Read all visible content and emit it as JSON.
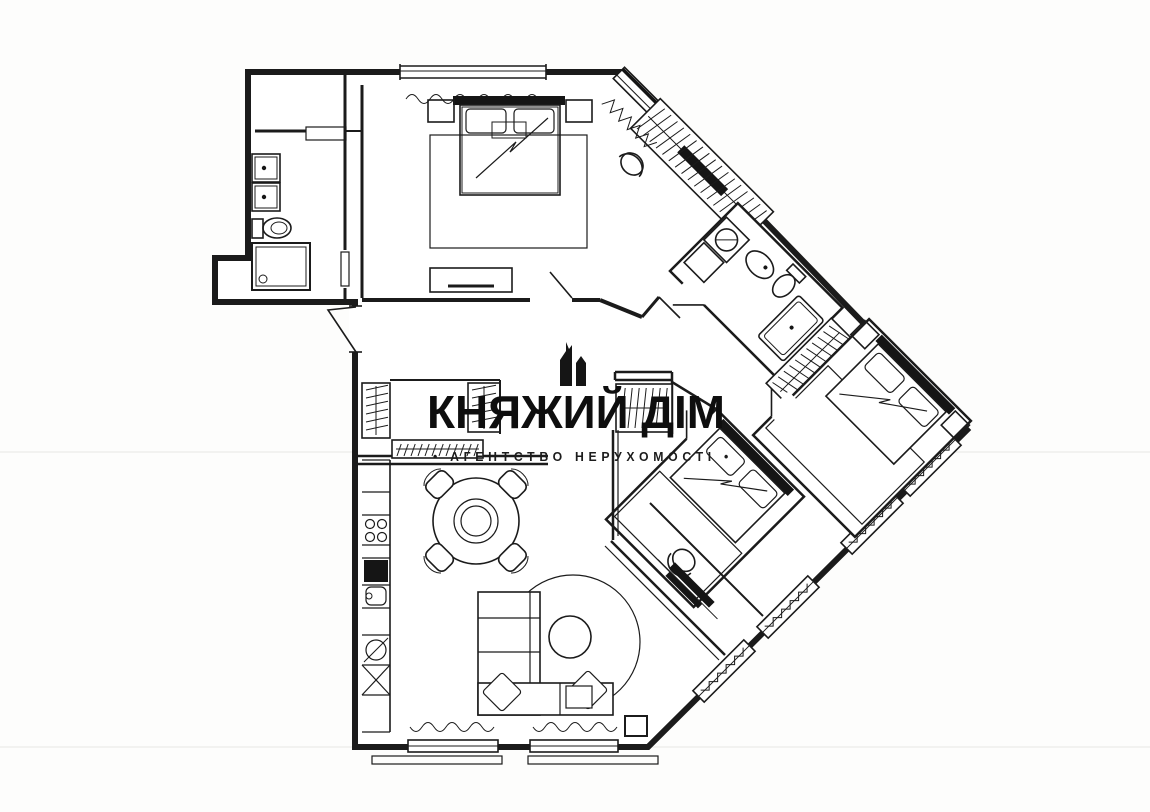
{
  "watermark": {
    "title": "КНЯЖИЙ ДІМ",
    "subtitle": "• АГЕНТСТВО  НЕРУХОМОСТІ •",
    "icon": "castle-towers-icon",
    "text_color": "#111111"
  },
  "plan": {
    "page_background": "#f4f4f2",
    "canvas_background": "#fdfdfc",
    "line_color": "#1b1b1b",
    "fixture_icons": [
      "double-sink-icon",
      "toilet-icon",
      "shower-icon",
      "wardrobe-hangers-icon",
      "double-bed-icon",
      "nightstand-icon",
      "rug-icon",
      "dresser-icon",
      "armchair-icon",
      "washing-machine-icon",
      "sink-icon",
      "shower-tray-icon",
      "dining-table-icon",
      "dining-chair-icon",
      "cooktop-icon",
      "kitchen-sink-icon",
      "dishwasher-icon",
      "sofa-icon",
      "coffee-table-icon",
      "window-icon",
      "door-swing-icon",
      "bench-icon"
    ]
  }
}
